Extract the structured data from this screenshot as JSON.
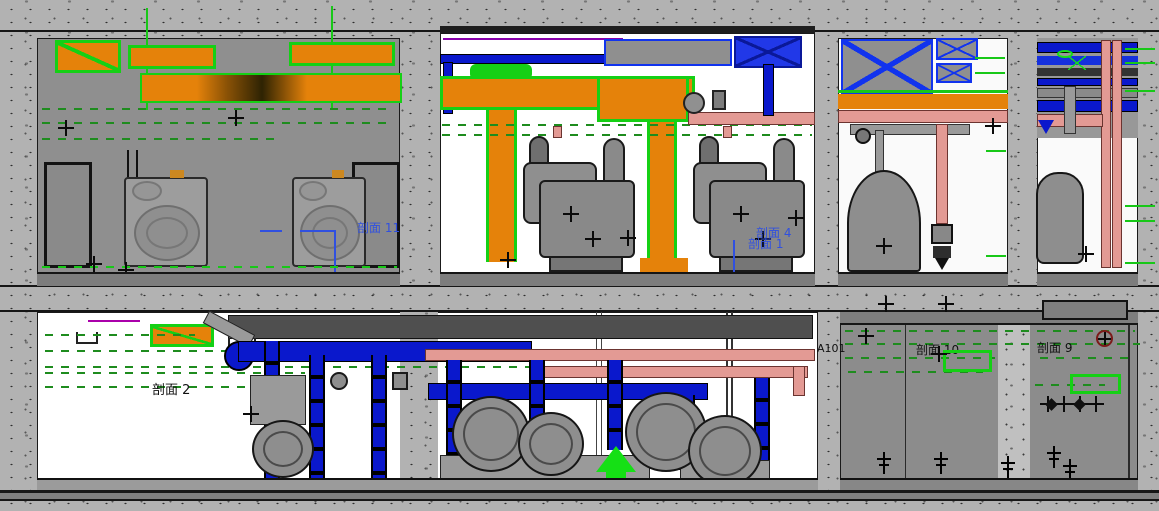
{
  "drawing": {
    "labels": {
      "section_11": "剖面 11",
      "section_4": "剖面 4",
      "section_1": "剖面 1",
      "section_2": "剖面 2",
      "grid_ref": "A101",
      "section_10": "剖面 10",
      "section_9": "剖面 9"
    },
    "colors": {
      "duct_orange": "#e5820a",
      "selection_green": "#15d015",
      "pipe_blue": "#0a18cc",
      "pipe_pink": "#e39a94",
      "annotation_blue": "#3050e0",
      "dash_green": "#1e8c1e",
      "concrete_gray": "#b2b2b2",
      "room_gray": "#8f8f8f"
    },
    "icons": {
      "cross_marker": "+",
      "double_tick_marker": "ǂ",
      "diamond_marker": "◆",
      "circle_cross_marker": "⊕",
      "down_arrow": "▼"
    }
  }
}
